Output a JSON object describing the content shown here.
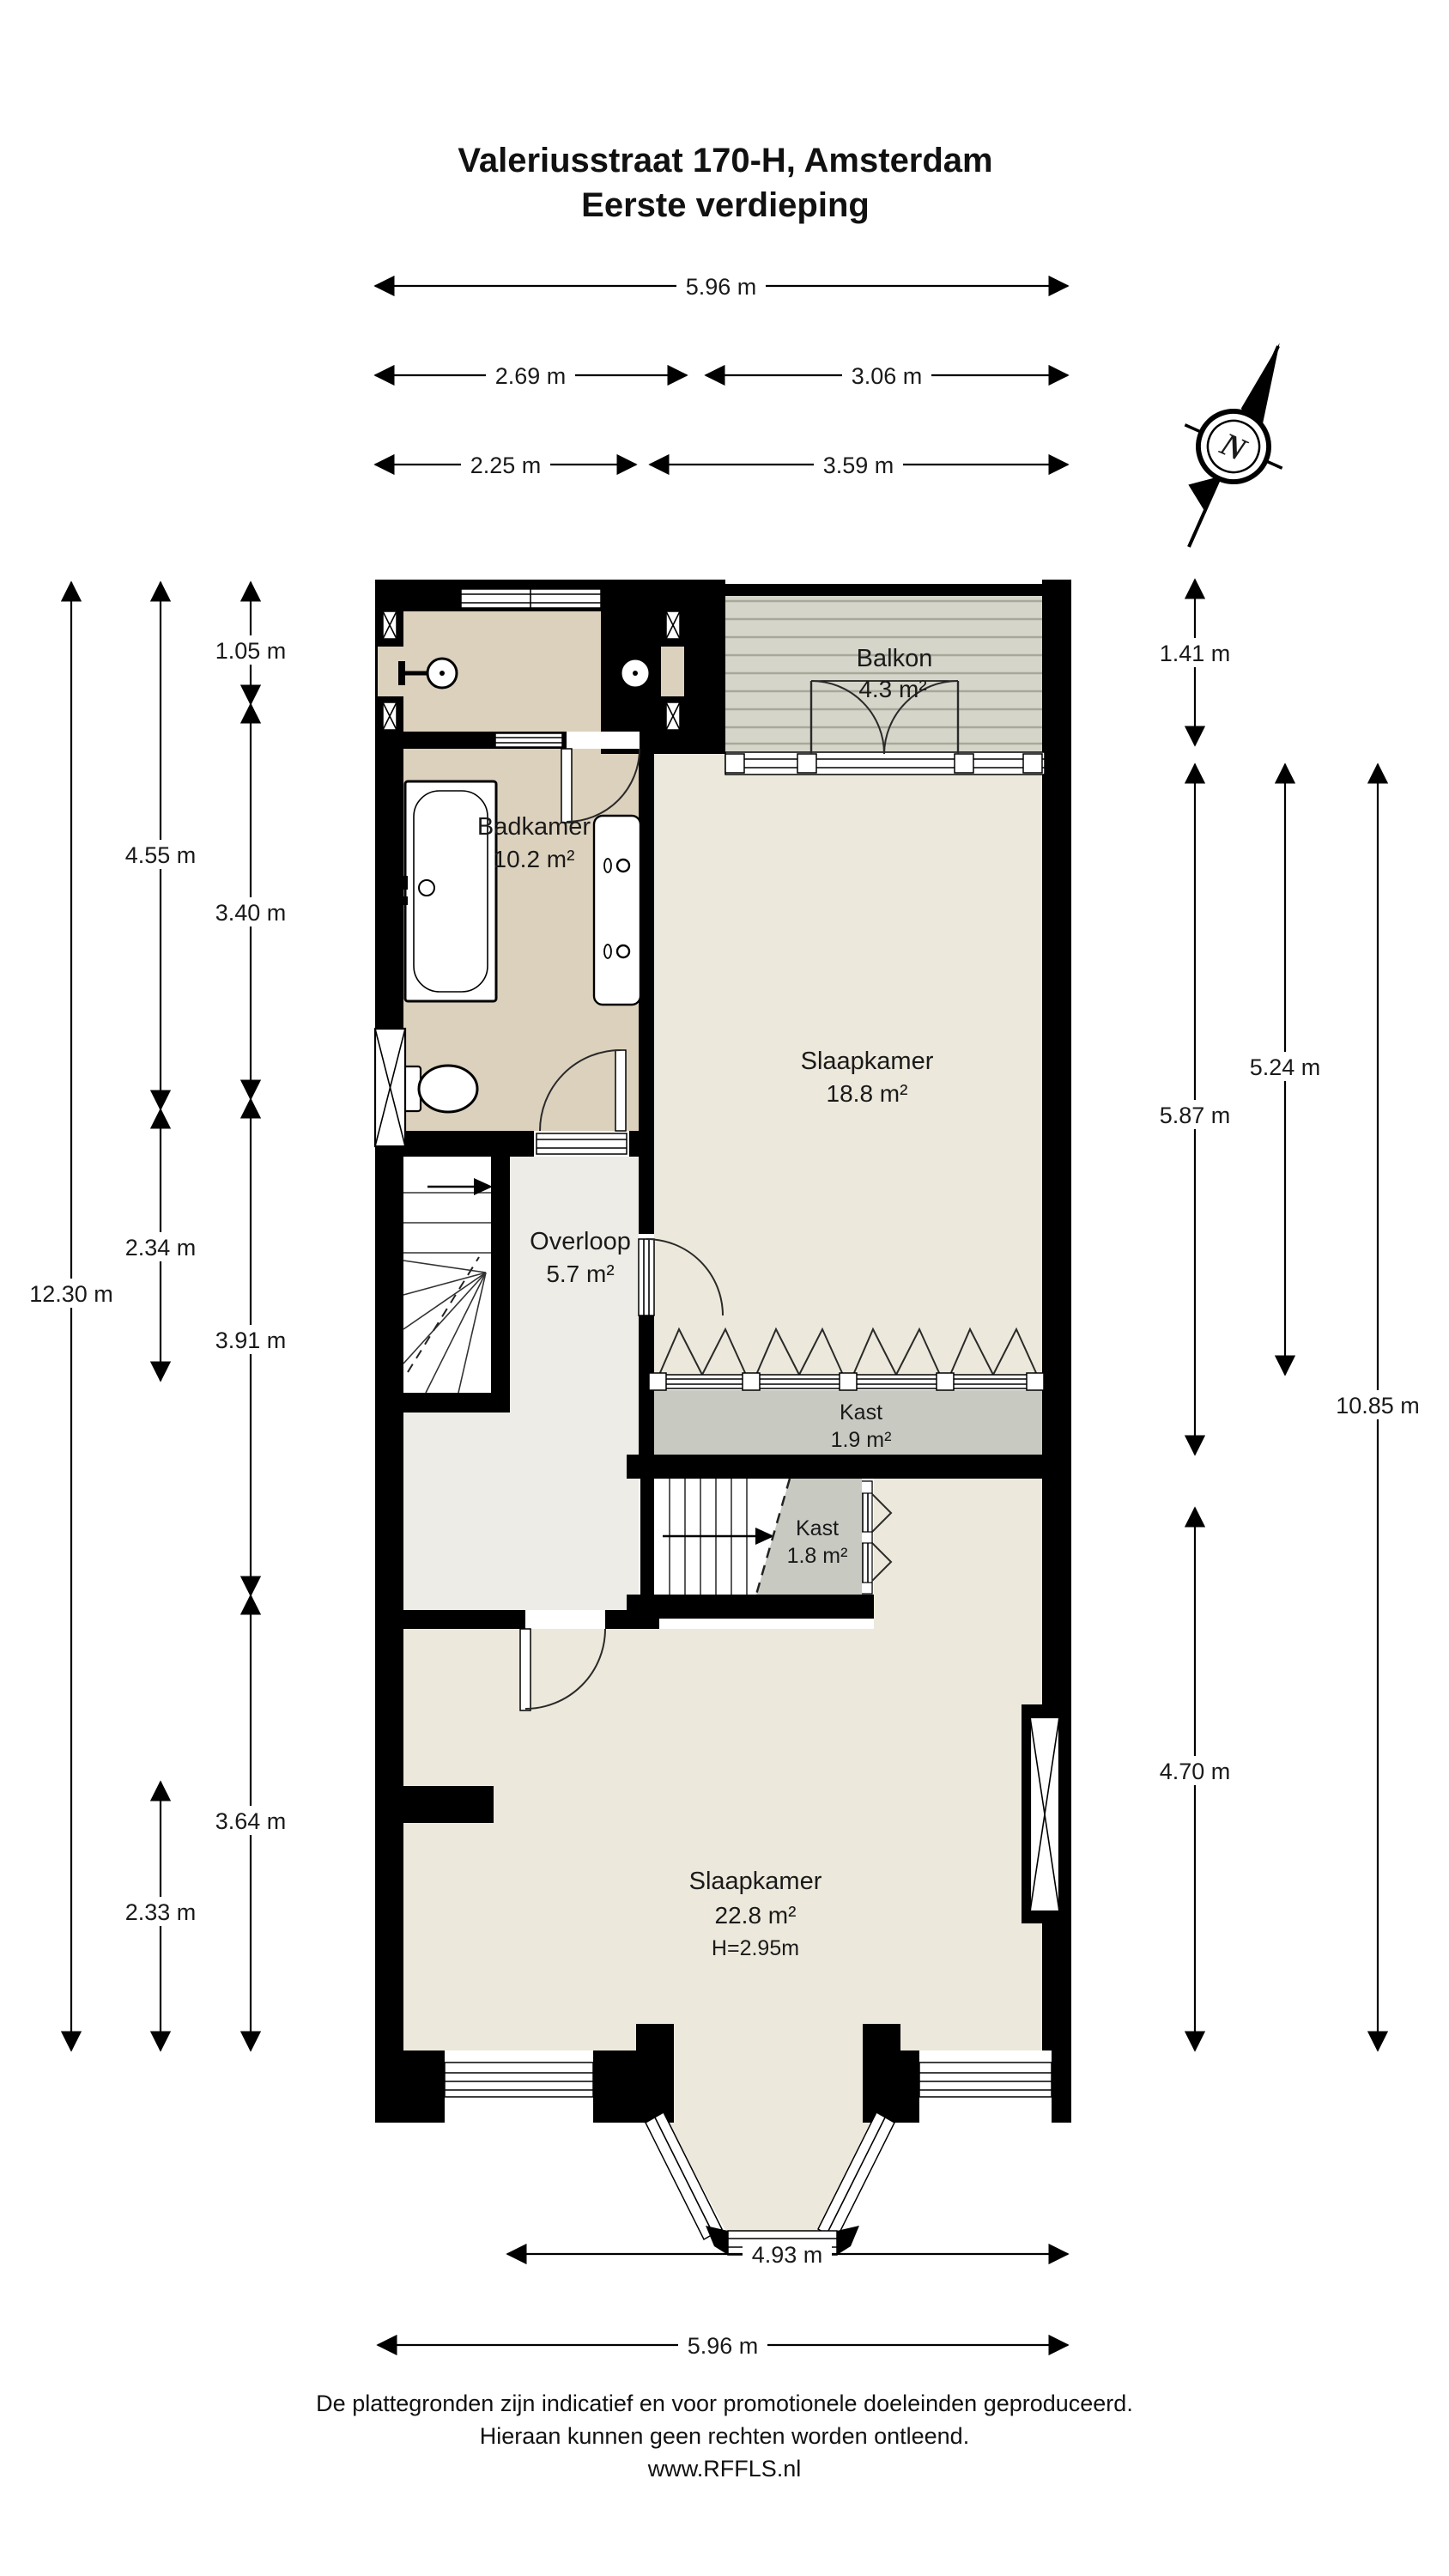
{
  "title": {
    "line1": "Valeriusstraat 170-H, Amsterdam",
    "line2": "Eerste verdieping"
  },
  "compass": {
    "label": "N"
  },
  "rooms": {
    "balkon": {
      "name": "Balkon",
      "area": "4.3 m²"
    },
    "badkamer": {
      "name": "Badkamer",
      "area": "10.2 m²"
    },
    "slaapkamer1": {
      "name": "Slaapkamer",
      "area": "18.8 m²"
    },
    "overloop": {
      "name": "Overloop",
      "area": "5.7 m²"
    },
    "kast1": {
      "name": "Kast",
      "area": "1.9 m²"
    },
    "kast2": {
      "name": "Kast",
      "area": "1.8 m²"
    },
    "slaapkamer2": {
      "name": "Slaapkamer",
      "area": "22.8 m²",
      "ceiling": "H=2.95m"
    }
  },
  "dimensions": {
    "top": [
      {
        "label": "5.96 m"
      },
      {
        "label": "2.69 m"
      },
      {
        "label": "3.06 m"
      },
      {
        "label": "2.25 m"
      },
      {
        "label": "3.59 m"
      }
    ],
    "left": [
      {
        "label": "12.30 m"
      },
      {
        "label": "4.55 m"
      },
      {
        "label": "2.34 m"
      },
      {
        "label": "2.33 m"
      },
      {
        "label": "1.05 m"
      },
      {
        "label": "3.40 m"
      },
      {
        "label": "3.91 m"
      },
      {
        "label": "3.64 m"
      }
    ],
    "right": [
      {
        "label": "1.41 m"
      },
      {
        "label": "5.87 m"
      },
      {
        "label": "4.70 m"
      },
      {
        "label": "5.24 m"
      },
      {
        "label": "10.85 m"
      }
    ],
    "bottom": [
      {
        "label": "4.93 m"
      },
      {
        "label": "5.96 m"
      }
    ]
  },
  "footer": {
    "line1": "De plattegronden zijn indicatief en voor promotionele doeleinden geproduceerd.",
    "line2": "Hieraan kunnen geen rechten worden ontleend.",
    "line3": "www.RFFLS.nl"
  },
  "colors": {
    "wall": "#000000",
    "bath": "#dcd1bd",
    "bedroom": "#ece8db",
    "hall": "#edece6",
    "closet": "#c8cac2",
    "balcony": "#d5d5ca",
    "balcony_line": "#a7a79a"
  }
}
